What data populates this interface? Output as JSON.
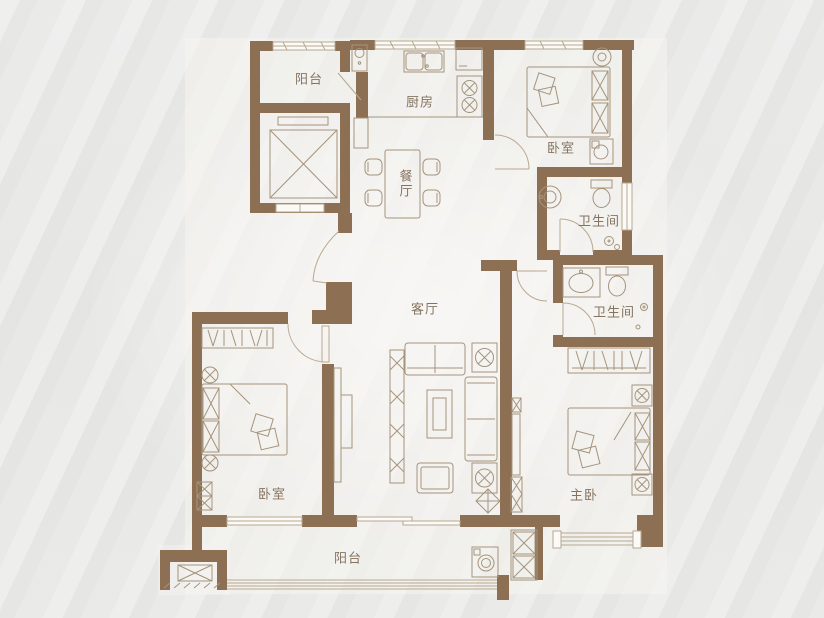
{
  "plan": {
    "type": "apartment-floor-plan",
    "colors": {
      "wall": "#8d6f54",
      "furniture_line": "#a5947c",
      "door_line": "#b9a98f",
      "label_text": "#85735f",
      "background": "#e9e9e7",
      "floor": "#f5f4f1"
    },
    "rooms": [
      {
        "id": "balcony-top",
        "label": "阳台"
      },
      {
        "id": "kitchen",
        "label": "厨房"
      },
      {
        "id": "bedroom-top-right",
        "label": "卧室"
      },
      {
        "id": "bathroom-upper",
        "label": "卫生间"
      },
      {
        "id": "bathroom-lower",
        "label": "卫生间"
      },
      {
        "id": "dining-room",
        "label": "餐厅"
      },
      {
        "id": "living-room",
        "label": "客厅"
      },
      {
        "id": "bedroom-bottom-left",
        "label": "卧室"
      },
      {
        "id": "master-bedroom",
        "label": "主卧"
      },
      {
        "id": "balcony-bottom",
        "label": "阳台"
      }
    ]
  }
}
